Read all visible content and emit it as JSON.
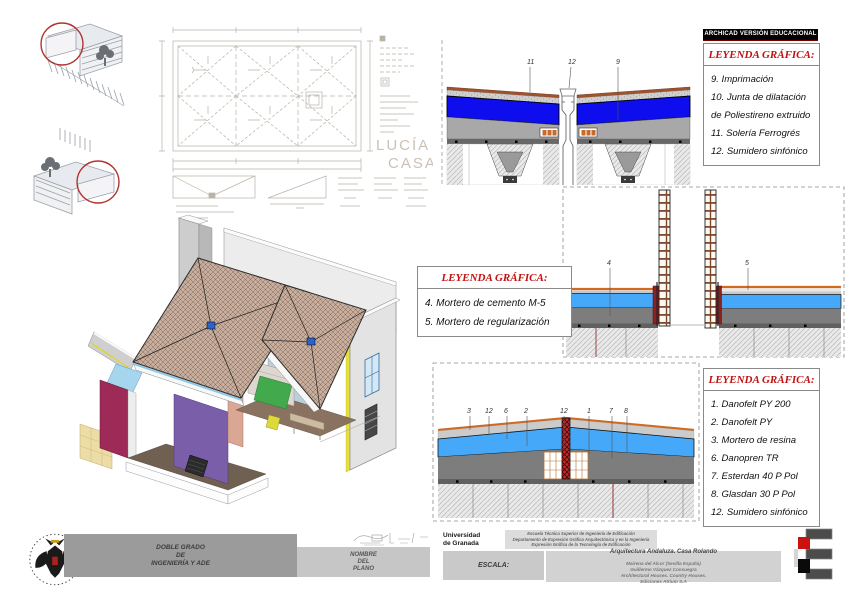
{
  "banner": {
    "text": "ARCHICAD VERSIÓN EDUCACIONAL"
  },
  "legends": {
    "top_right": {
      "title": "LEYENDA GRÁFICA:",
      "items": [
        "9. Imprimación",
        "10. Junta de dilatación",
        "de Poliestireno extruido",
        "11. Solería Ferrogrés",
        "12. Sumidero sinfónico"
      ]
    },
    "middle": {
      "title": "LEYENDA GRÁFICA:",
      "items": [
        "4. Mortero de cemento M-5",
        "5. Mortero de regularización"
      ]
    },
    "bottom_right": {
      "title": "LEYENDA GRÁFICA:",
      "items": [
        "1. Danofelt PY 200",
        "2. Danofelt PY",
        "3. Mortero de resina",
        "6. Danopren TR",
        "7. Esterdan 40 P Pol",
        "8. Glasdan 30 P Pol",
        "12. Sumidero sinfónico"
      ]
    }
  },
  "details": {
    "top": {
      "labels": [
        "11",
        "12",
        "9"
      ]
    },
    "middle": {
      "labels": [
        "4",
        "5"
      ]
    },
    "bottom": {
      "labels": [
        "3",
        "12",
        "6",
        "2",
        "12",
        "1",
        "7",
        "8"
      ]
    }
  },
  "sketch": {
    "signature_line1": "LUCÍA",
    "signature_line2": "CASADO"
  },
  "titleblock": {
    "degree": "DOBLE GRADO\nDE\nINGENIERÍA Y ADE",
    "plan_name": "NOMBRE\nDEL\nPLANO",
    "university": "Universidad\nde Granada",
    "department": "Escuela Técnica Superior de Ingeniería de Edificación\nDepartamento de Expresión Gráfica Arquitectónica y en la Ingeniería\nExpresión Gráfica de la Tecnología de Edificación",
    "scale_label": "ESCALA:",
    "project_title": "Arquitectura Andaluza. Casa Rolando",
    "project_lines": "Mairena del Alcor (Sevilla España)\nGuillermo Vázquez Consuegra\nArchitectural Houses. Country Houses.\nEdiciones Atrium S.A"
  },
  "colors": {
    "legend_red": "#c11212",
    "deep_blue": "#0d0dee",
    "sky_blue": "#45a8f8",
    "roof_tan": "#c9ae9d",
    "banner_bg": "#000000",
    "drain_red": "#c62828"
  }
}
